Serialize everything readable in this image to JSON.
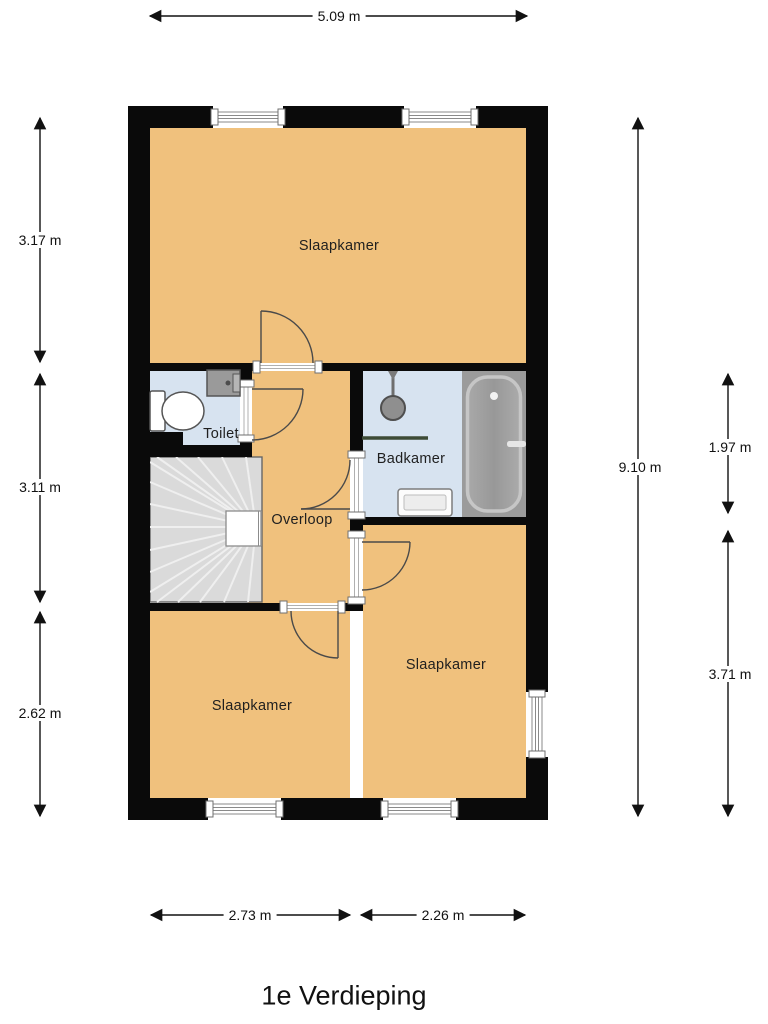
{
  "title": "1e Verdieping",
  "rooms": {
    "slaapkamer_top": {
      "label": "Slaapkamer"
    },
    "toilet": {
      "label": "Toilet"
    },
    "overloop": {
      "label": "Overloop"
    },
    "badkamer": {
      "label": "Badkamer"
    },
    "slaapkamer_left": {
      "label": "Slaapkamer"
    },
    "slaapkamer_right": {
      "label": "Slaapkamer"
    }
  },
  "dimensions": {
    "top": "5.09 m",
    "left_top": "3.17 m",
    "left_middle": "3.11 m",
    "left_bottom": "2.62 m",
    "right_total": "9.10 m",
    "right_badkamer": "1.97 m",
    "right_slaapkamer": "3.71 m",
    "bottom_left": "2.73 m",
    "bottom_right": "2.26 m"
  },
  "colors": {
    "room": "#F0C17D",
    "wet": "#D7E3F0",
    "wall": "#0A0A0A",
    "stairs": "#DADADA",
    "tub_panel": "#9B9B9B",
    "divider": "#3D4B36"
  }
}
